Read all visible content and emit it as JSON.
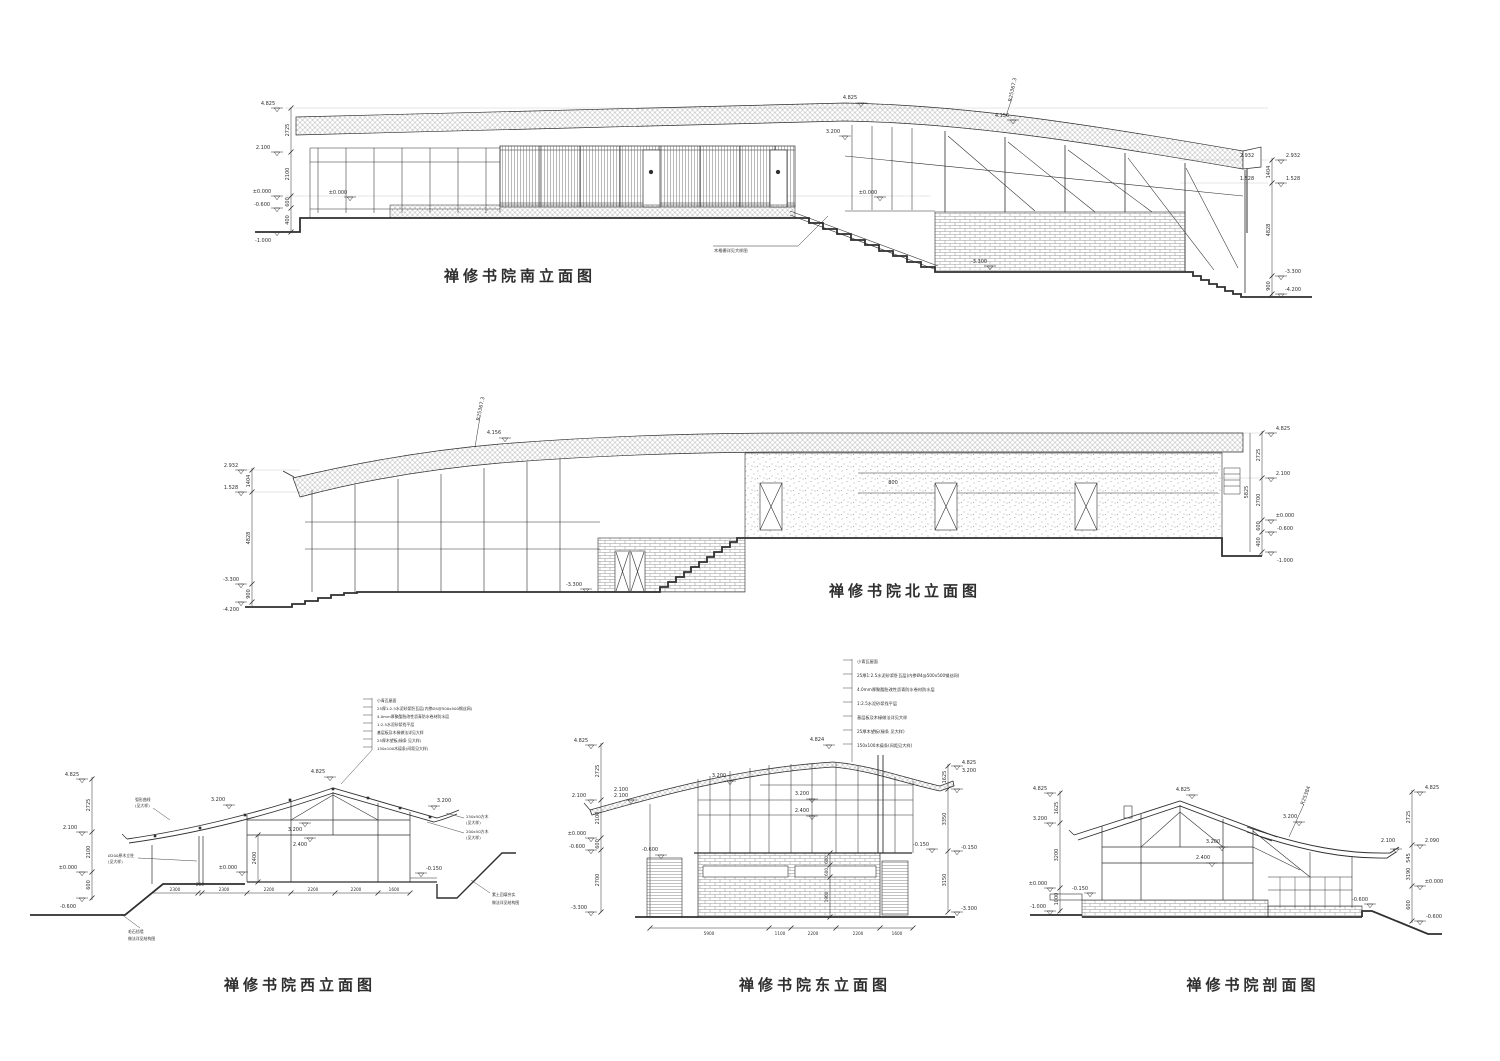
{
  "sheet": {
    "background": "#ffffff",
    "ink": "#2f2f2f",
    "faint": "#c8c8c8"
  },
  "titles": {
    "south": "禅修书院南立面图",
    "north": "禅修书院北立面图",
    "west": "禅修书院西立面图",
    "east": "禅修书院东立面图",
    "section": "禅修书院剖面图"
  },
  "roof_notes": [
    "小青瓦屋面",
    "25厚1:2.5水泥砂浆卧瓦层(内掺Ø4@500x500钢丝网)",
    "4.0mm厚聚酯胎改性沥青防水卷材防水层",
    "1:2.5水泥砂浆找平层",
    "基层板及木椽做法详见大样",
    "25厚木望板(椽条 见大样)",
    "150x100木檩条(间距见大样)"
  ],
  "south": {
    "mid_top_level": "4.825",
    "eave_level": "3.200",
    "roof_level": "4.156",
    "radius": "R25367.3",
    "zero_a": "±0.000",
    "zero_b": "±0.000",
    "wall_level": "-3.300",
    "screen_note": "木格栅详见大样图",
    "chainL_levels": [
      "4.825",
      "2.100",
      "±0.000",
      "-0.600",
      "-1.000"
    ],
    "chainL_dims": [
      "2725",
      "2100",
      "600",
      "400"
    ],
    "chainR_levels": [
      "2.932",
      "1.528",
      "-3.300",
      "-4.200"
    ],
    "chainR_dims": [
      "1404",
      "4828",
      "900"
    ]
  },
  "north": {
    "roof_level": "4.156",
    "radius": "R25367.3",
    "strip_dim": "800",
    "ground_level": "-3.300",
    "chainL_levels": [
      "2.932",
      "1.528",
      "-3.300",
      "-4.200"
    ],
    "chainL_dims": [
      "1404",
      "4828",
      "900"
    ],
    "chainR_levels": [
      "4.825",
      "2.100",
      "±0.000",
      "-0.600",
      "-1.000"
    ],
    "chainR_dims": [
      "2725",
      "5825",
      "2700",
      "600",
      "400"
    ]
  },
  "west": {
    "ridge_level": "4.825",
    "slope_left_level": "3.200",
    "slope_right_level": "3.200",
    "inner_level_a": "3.200",
    "inner_level_b": "2.400",
    "inner_dim": "2400",
    "zero_inner": "±0.000",
    "right_ground_level": "-0.150",
    "chainL_levels": [
      "4.825",
      "2.100",
      "±0.000",
      "-0.600"
    ],
    "chainL_dims": [
      "2725",
      "2100",
      "600"
    ],
    "bottom_dims": [
      "2300",
      "200",
      "2300",
      "2200",
      "2200",
      "2200",
      "1600"
    ],
    "note_column": [
      "Ø200原木立柱",
      "(见大样)"
    ],
    "note_curve": [
      "弧形曲线",
      "(见大样)"
    ],
    "note_purlin_250": [
      "250x50方木",
      "(见大样)"
    ],
    "note_purlin_200": [
      "200x50方木",
      "(见大样)"
    ],
    "note_stone_wall": [
      "毛石挡墙",
      "做法详见结构图"
    ],
    "note_fill": [
      "素土回填夯实",
      "做法详见结构图"
    ]
  },
  "east": {
    "ridge_level": "4.824",
    "slope_level": "3.200",
    "eave_level_a": "2.100",
    "eave_level_b": "2.100",
    "inner_level_a": "3.200",
    "inner_level_b": "2.400",
    "screen_level": "-0.600",
    "wall_top_level": "-0.150",
    "v_dims": [
      "600",
      "600",
      "1900"
    ],
    "chainL_levels": [
      "4.825",
      "2.100",
      "±0.000",
      "-0.600",
      "-3.300"
    ],
    "chainL_dims": [
      "2725",
      "2100",
      "600",
      "2700"
    ],
    "chainR_levels": [
      "4.825",
      "3.200",
      "-0.150",
      "-3.300"
    ],
    "chainR_dims": [
      "1625",
      "3350",
      "3150"
    ],
    "bottom_dims": [
      "5900",
      "1100",
      "2200",
      "2200",
      "1600"
    ]
  },
  "section": {
    "ridge_level": "4.825",
    "radius": "R25384",
    "slope_level": "3.200",
    "inner_level_a": "3.200",
    "inner_level_b": "2.400",
    "eave_level": "2.100",
    "slab_level": "-0.150",
    "platform_level": "-0.600",
    "chainL_levels": [
      "4.825",
      "3.200",
      "±0.000",
      "-1.000"
    ],
    "chainL_dims": [
      "1625",
      "3200",
      "1000"
    ],
    "chainR_levels": [
      "4.825",
      "2.090",
      "±0.000",
      "-0.600"
    ],
    "chainR_dims": [
      "2725",
      "545",
      "3190",
      "600"
    ]
  }
}
